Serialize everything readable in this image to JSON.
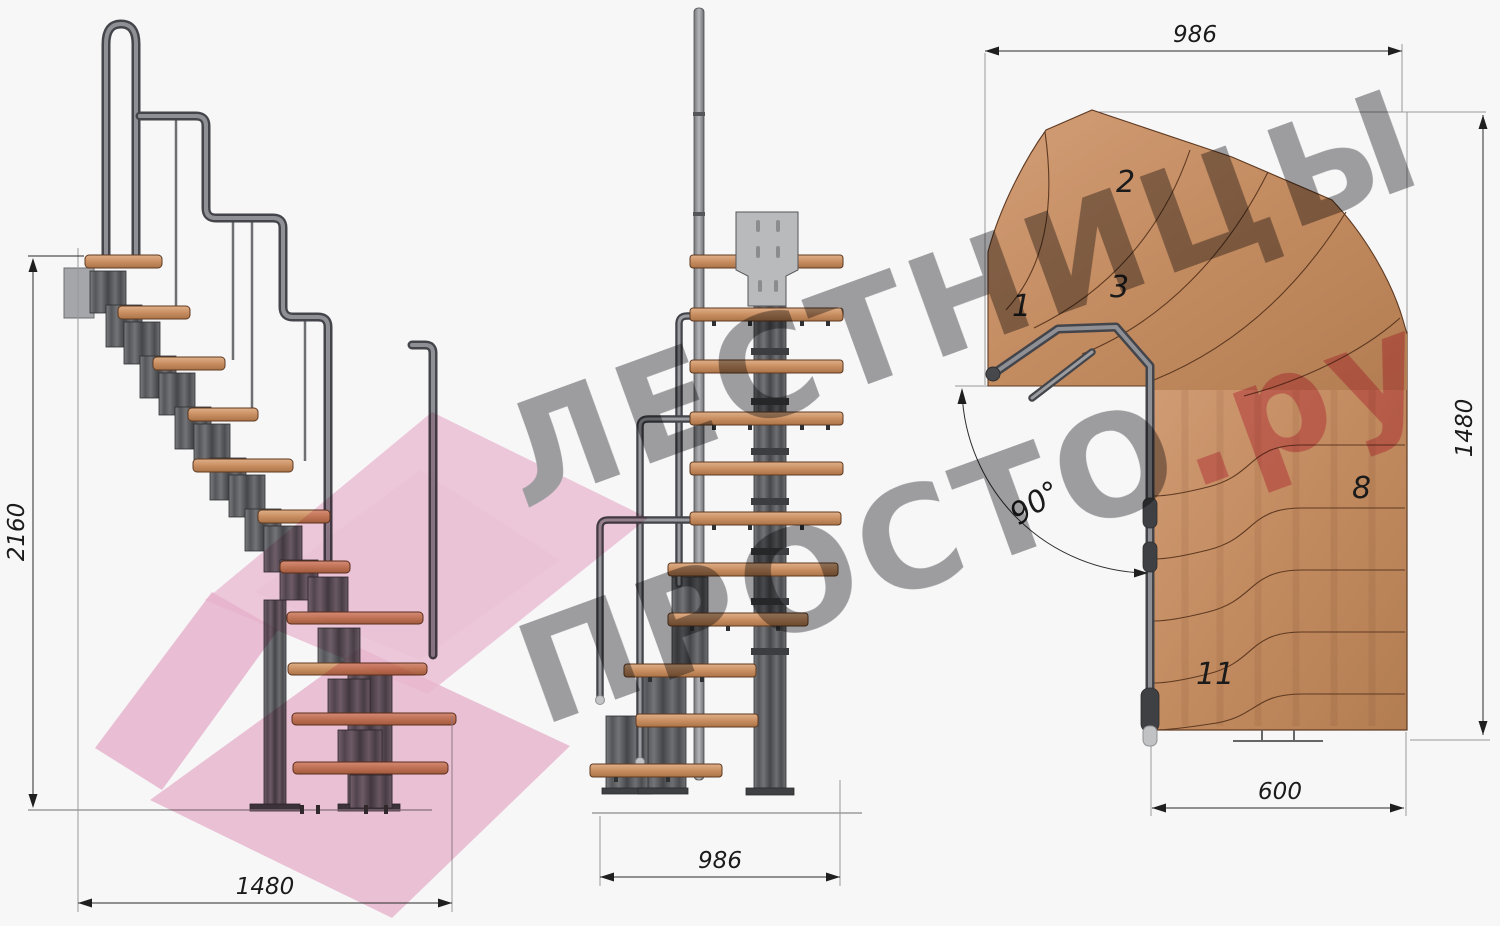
{
  "watermark": {
    "line1": "ЛЕСТНИЦЫ",
    "line2": "ПРОСТО",
    "suffix": ".ру"
  },
  "dimensions": {
    "side_height": "2160",
    "side_width": "1480",
    "front_width": "986",
    "plan_top": "986",
    "plan_right": "1480",
    "plan_bottom": "600",
    "turn_angle": "90°"
  },
  "plan_tread_labels": {
    "t1": "1",
    "t2": "2",
    "t3": "3",
    "t8": "8",
    "t11": "11"
  },
  "colors": {
    "wood": "#c98f62",
    "steel_dark": "#45464a",
    "steel": "#6b6d71",
    "outline": "#5e3a22",
    "dimension_line": "#2a2a2a",
    "watermark_gray": "#a2a2a4",
    "watermark_pink": "#f2c6da",
    "watermark_accent": "#f0a9c1",
    "background": "#f7f7f8"
  }
}
